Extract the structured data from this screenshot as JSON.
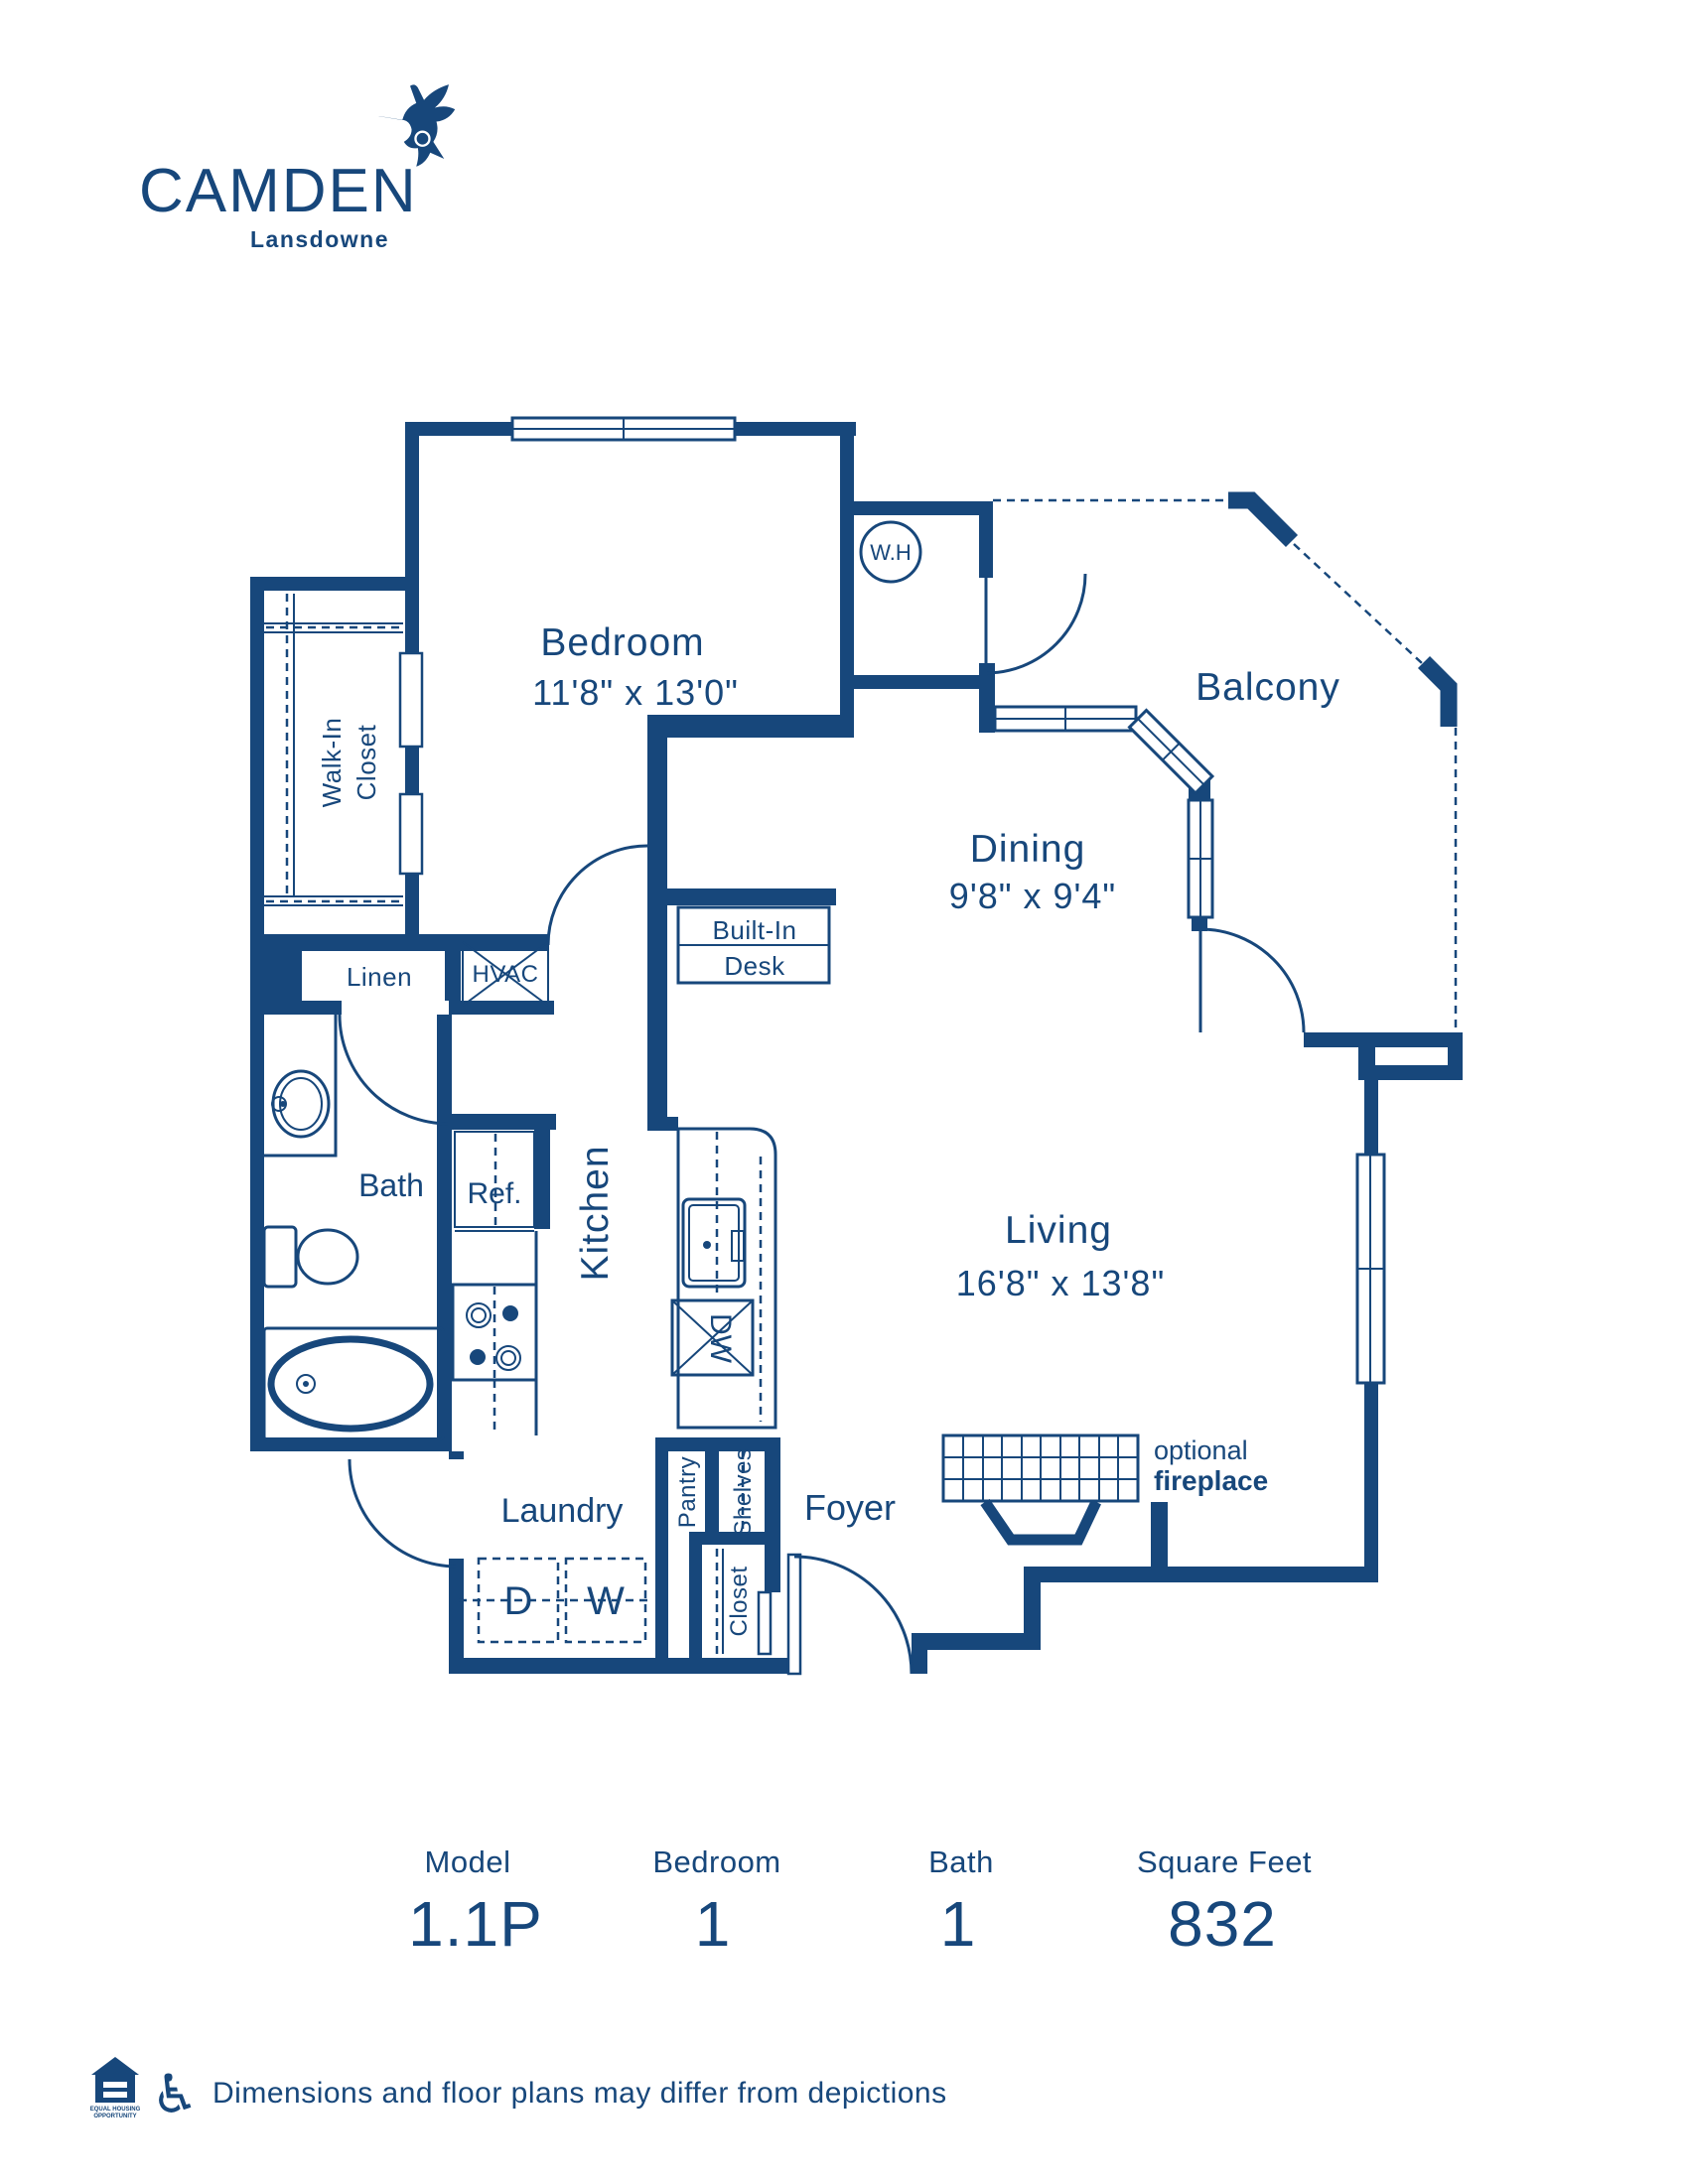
{
  "brand": {
    "name": "CAMDEN",
    "location": "Lansdowne"
  },
  "colors": {
    "navy": "#17477B",
    "background": "#FFFFFF"
  },
  "plan": {
    "rooms": {
      "bedroom": {
        "name": "Bedroom",
        "dims": "11'8\" x 13'0\""
      },
      "dining": {
        "name": "Dining",
        "dims": "9'8\" x 9'4\""
      },
      "living": {
        "name": "Living",
        "dims": "16'8\" x 13'8\""
      },
      "balcony": {
        "name": "Balcony"
      },
      "bath": {
        "name": "Bath"
      },
      "kitchen": {
        "name": "Kitchen"
      },
      "laundry": {
        "name": "Laundry"
      },
      "foyer": {
        "name": "Foyer"
      }
    },
    "features": {
      "walk_in_closet_line1": "Walk-In",
      "walk_in_closet_line2": "Closet",
      "linen": "Linen",
      "hvac": "HVAC",
      "built_in_desk_line1": "Built-In",
      "built_in_desk_line2": "Desk",
      "water_heater": "W.H",
      "refrigerator": "Ref.",
      "dishwasher": "DW",
      "dryer": "D",
      "washer": "W",
      "pantry": "Pantry",
      "shelves": "Shelves",
      "closet": "Closet",
      "fireplace_line1": "optional",
      "fireplace_line2": "fireplace"
    }
  },
  "summary": {
    "columns": [
      {
        "label": "Model",
        "value": "1.1P"
      },
      {
        "label": "Bedroom",
        "value": "1"
      },
      {
        "label": "Bath",
        "value": "1"
      },
      {
        "label": "Square Feet",
        "value": "832"
      }
    ]
  },
  "footer": {
    "eho_line1": "EQUAL HOUSING",
    "eho_line2": "OPPORTUNITY",
    "accessibility_icon": "♿",
    "disclaimer": "Dimensions and floor plans may differ from depictions"
  }
}
